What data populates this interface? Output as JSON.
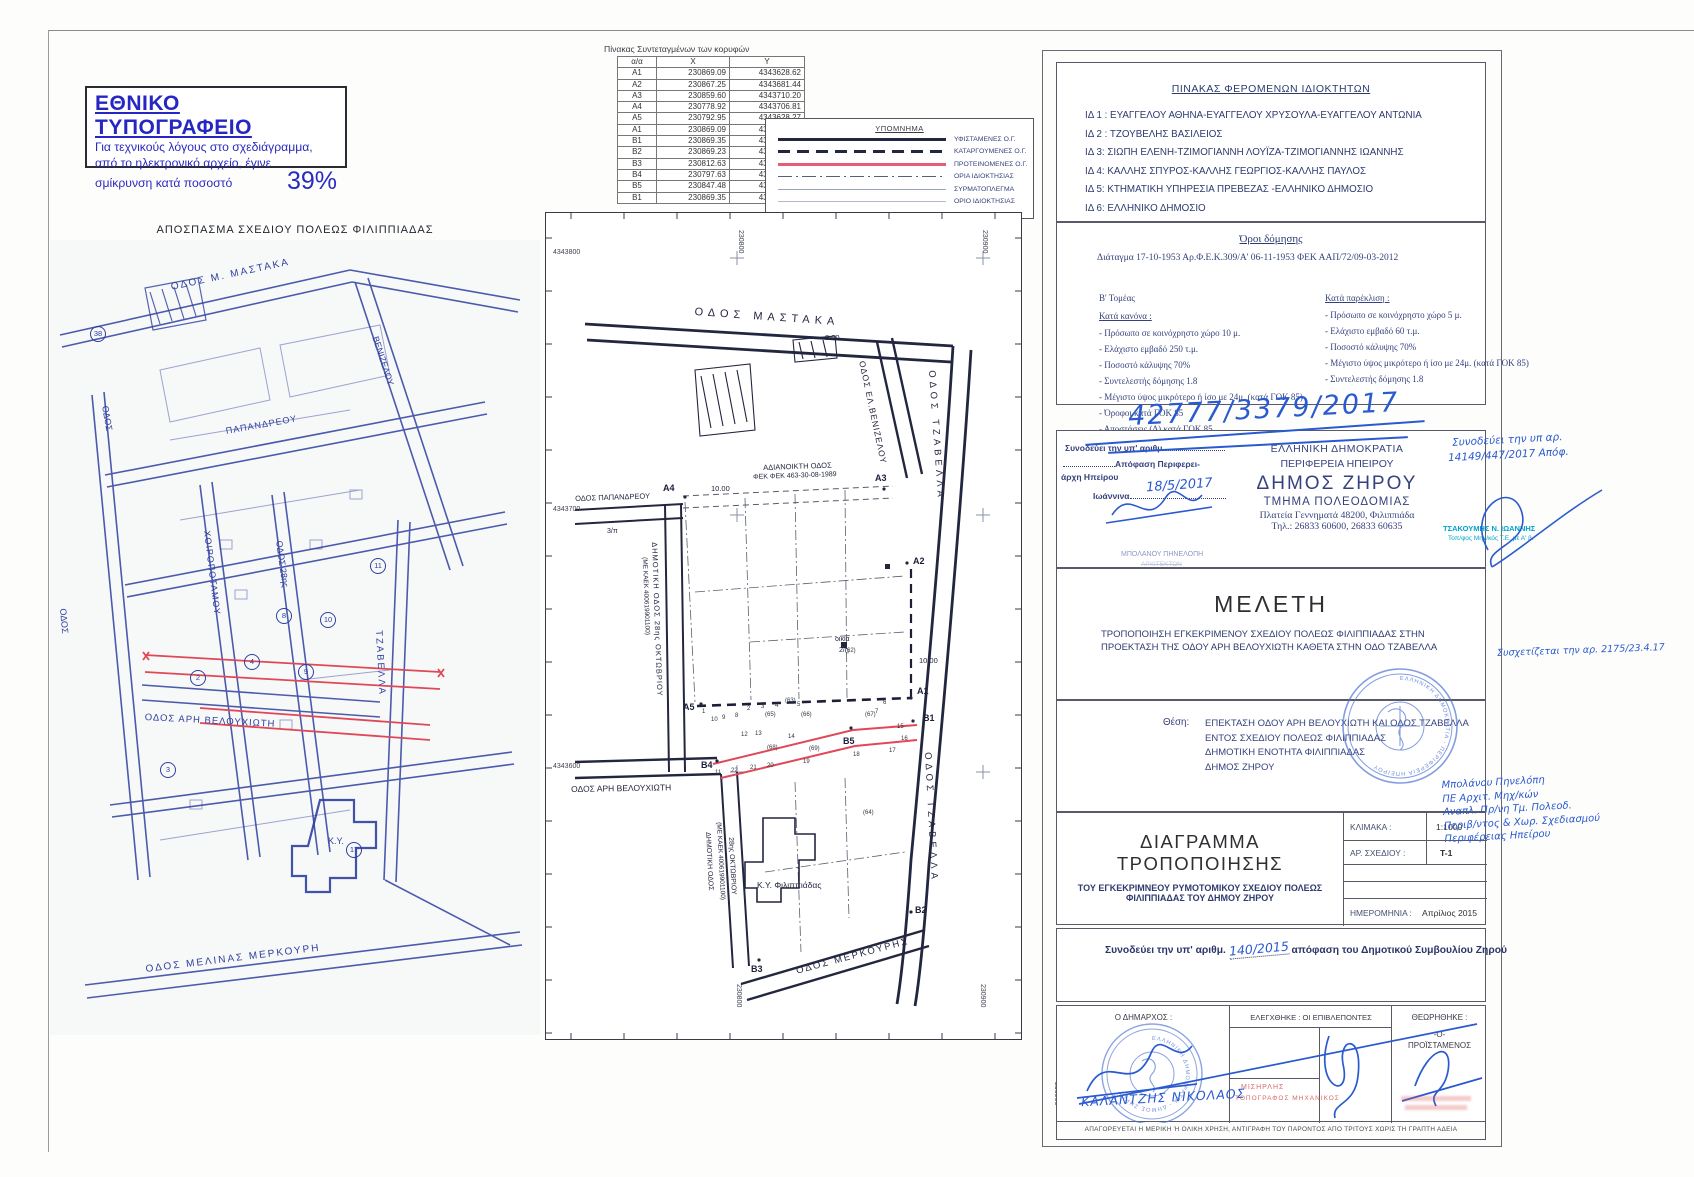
{
  "notice": {
    "title": "ΕΘΝΙΚΟ ΤΥΠΟΓΡΑΦΕΙΟ",
    "line1": "Για τεχνικούς λόγους στο σχεδιάγραμμα,",
    "line2": "από το ηλεκτρονικό αρχείο, έγινε",
    "line3": "σμίκρυνση κατά ποσοστό",
    "percent": "39%"
  },
  "coords_table": {
    "title": "Πίνακας Συντεταγμένων των κορυφών",
    "headers": [
      "α/α",
      "X",
      "Y"
    ],
    "rows": [
      [
        "A1",
        "230869.09",
        "4343628.62"
      ],
      [
        "A2",
        "230867.25",
        "4343681.44"
      ],
      [
        "A3",
        "230859.60",
        "4343710.20"
      ],
      [
        "A4",
        "230778.92",
        "4343706.81"
      ],
      [
        "A5",
        "230792.95",
        "4343628.27"
      ],
      [
        "A1",
        "230869.09",
        "4343628.62"
      ],
      [
        "B1",
        "230869.35",
        "4343619.13"
      ],
      [
        "B2",
        "230869.23",
        "4343544.37"
      ],
      [
        "B3",
        "230812.63",
        "4343526.20"
      ],
      [
        "B4",
        "230797.63",
        "4343604.03"
      ],
      [
        "B5",
        "230847.48",
        "4343619.03"
      ],
      [
        "B1",
        "230869.35",
        "4343619.13"
      ]
    ]
  },
  "legend": {
    "title": "ΥΠΟΜΝΗΜΑ",
    "items": [
      {
        "label": "ΥΦΙΣΤΑΜΕΝΕΣ Ο.Γ.",
        "style": "ls-solid-black"
      },
      {
        "label": "ΚΑΤΑΡΓΟΥΜΕΝΕΣ Ο.Γ.",
        "style": "ls-dashed-black"
      },
      {
        "label": "ΠΡΟΤΕΙΝΟΜΕΝΕΣ Ο.Γ.",
        "style": "ls-solid-red"
      },
      {
        "label": "ΟΡΙΑ ΙΔΙΟΚΤΗΣΙΑΣ",
        "style": "ls-dashdot"
      },
      {
        "label": "ΣΥΡΜΑΤΟΠΛΕΓΜΑ",
        "style": "ls-thin"
      },
      {
        "label": "ΟΡΙΟ ΙΔΙΟΚΤΗΣΙΑΣ",
        "style": "ls-thin2"
      }
    ]
  },
  "left_map": {
    "title": "ΑΠΟΣΠΑΣΜΑ ΣΧΕΔΙΟΥ ΠΟΛΕΩΣ ΦΙΛΙΠΠΙΑΔΑΣ",
    "labels": [
      {
        "t": "ΟΔΟΣ Μ. ΜΑΣΤΑΚΑ",
        "x": 120,
        "y": 42,
        "r": -12,
        "fs": 10,
        "ls": 2
      },
      {
        "t": "ΠΑΠΑΝΔΡΕΟΥ",
        "x": 175,
        "y": 186,
        "r": -10,
        "fs": 9,
        "ls": 1
      },
      {
        "t": "ΟΔΟΣ",
        "x": 60,
        "y": 165,
        "r": 80,
        "fs": 9
      },
      {
        "t": "ΒΕΝΙΖΕΛΟΥ",
        "x": 330,
        "y": 95,
        "r": 72,
        "fs": 9
      },
      {
        "t": "ΧΟΙΡΟΠΟΤΑΜΟΥ",
        "x": 162,
        "y": 290,
        "r": 83,
        "fs": 9,
        "ls": 1
      },
      {
        "t": "ΟΔΟΣ 28ης",
        "x": 234,
        "y": 300,
        "r": 82,
        "fs": 9
      },
      {
        "t": "ΟΔΟΣ ΑΡΗ ΒΕΛΟΥΧΙΩΤΗ",
        "x": 95,
        "y": 472,
        "r": 3,
        "fs": 9.5,
        "ls": 1
      },
      {
        "t": "ΤΖΑΒΕΛΛΑ",
        "x": 334,
        "y": 390,
        "r": 87,
        "fs": 9.5,
        "ls": 2
      },
      {
        "t": "ΟΔΟΣ",
        "x": 18,
        "y": 368,
        "r": 85,
        "fs": 9
      },
      {
        "t": "ΟΔΟΣ ΜΕΛΙΝΑΣ ΜΕΡΚΟΥΡΗ",
        "x": 95,
        "y": 724,
        "r": -7,
        "fs": 10,
        "ls": 2
      },
      {
        "t": "Κ.Υ.",
        "x": 278,
        "y": 596,
        "fs": 9
      }
    ],
    "circled_numbers": [
      {
        "t": "38",
        "x": 40,
        "y": 86
      },
      {
        "t": "8",
        "x": 226,
        "y": 368
      },
      {
        "t": "10",
        "x": 270,
        "y": 372
      },
      {
        "t": "4",
        "x": 194,
        "y": 414
      },
      {
        "t": "2",
        "x": 140,
        "y": 430
      },
      {
        "t": "3",
        "x": 110,
        "y": 522
      },
      {
        "t": "17",
        "x": 296,
        "y": 602
      },
      {
        "t": "9",
        "x": 248,
        "y": 424
      },
      {
        "t": "11",
        "x": 320,
        "y": 318
      }
    ]
  },
  "center_map": {
    "street_labels": [
      {
        "t": "ΟΔΟΣ ΜΑΣΤΑΚΑ",
        "x": 150,
        "y": 94,
        "r": 4,
        "fs": 11,
        "ls": 5
      },
      {
        "t": "ΟΔΟΣ ΕΛ.ΒΕΝΙΖΕΛΟΥ",
        "x": 322,
        "y": 148,
        "r": 78,
        "fs": 8.5,
        "ls": 1
      },
      {
        "t": "ΟΔΟΣ ΤΖΑΒΕΛΛΑ",
        "x": 392,
        "y": 158,
        "r": 86,
        "fs": 9.5,
        "ls": 4
      },
      {
        "t": "ΟΔΟΣ ΤΖΑΒΕΛΛΑ",
        "x": 388,
        "y": 540,
        "r": 87,
        "fs": 9.5,
        "ls": 4
      },
      {
        "t": "ΟΔΟΣ ΠΑΠΑΝΔΡΕΟΥ",
        "x": 30,
        "y": 282,
        "r": -2,
        "fs": 7.5
      },
      {
        "t": "ΑΔΙΑΝΟΙΚΤΗ ΟΔΟΣ",
        "x": 218,
        "y": 251,
        "r": -2,
        "fs": 7.5
      },
      {
        "t": "ΦΕΚ ΦΕΚ 463-30-08-1989",
        "x": 208,
        "y": 262,
        "r": -2,
        "fs": 7
      },
      {
        "t": "10.00",
        "x": 166,
        "y": 272,
        "fs": 7.5
      },
      {
        "t": "8.00",
        "x": 280,
        "y": 121,
        "fs": 7.5
      },
      {
        "t": "10.00",
        "x": 374,
        "y": 444,
        "fs": 7.5
      },
      {
        "t": "ΔΗΜΟΤΙΚΗ ΟΔΟΣ 28ης ΟΚΤΩΒΡΙΟΥ",
        "x": 114,
        "y": 330,
        "r": 88,
        "fs": 7.5,
        "ls": 1
      },
      {
        "t": "(ΜΕ ΚΑΕΚ 400619901100)",
        "x": 103,
        "y": 345,
        "r": 88,
        "fs": 6.5
      },
      {
        "t": "ΟΔΟΣ ΑΡΗ ΒΕΛΟΥΧΙΩΤΗ",
        "x": 26,
        "y": 572,
        "r": -1,
        "fs": 8.5
      },
      {
        "t": "ΔΗΜΟΤΙΚΗ ΟΔΟΣ",
        "x": 166,
        "y": 620,
        "r": 87,
        "fs": 7
      },
      {
        "t": "(ΜΕ ΚΑΕΚ 400619901100)",
        "x": 177,
        "y": 610,
        "r": 87,
        "fs": 6.5
      },
      {
        "t": "28ης ΟΚΤΩΒΡΙΟΥ",
        "x": 189,
        "y": 625,
        "r": 87,
        "fs": 7
      },
      {
        "t": "ΟΔΟΣ ΜΕΡΚΟΥΡΗΣ",
        "x": 250,
        "y": 754,
        "r": -15,
        "fs": 9.5,
        "ls": 2
      },
      {
        "t": "Κ.Υ. Φιλιππιάδας",
        "x": 212,
        "y": 668,
        "fs": 8.5
      },
      {
        "t": "οικία",
        "x": 290,
        "y": 424,
        "fs": 7
      },
      {
        "t": "2/η",
        "x": 294,
        "y": 435,
        "fs": 7
      },
      {
        "t": "3/π",
        "x": 62,
        "y": 316,
        "fs": 7
      }
    ],
    "point_labels": [
      {
        "t": "A1",
        "x": 372,
        "y": 474,
        "fs": 9,
        "b": 1
      },
      {
        "t": "A2",
        "x": 368,
        "y": 344,
        "fs": 9,
        "b": 1
      },
      {
        "t": "A3",
        "x": 330,
        "y": 261,
        "fs": 9,
        "b": 1
      },
      {
        "t": "A4",
        "x": 118,
        "y": 271,
        "fs": 9,
        "b": 1
      },
      {
        "t": "A5",
        "x": 138,
        "y": 490,
        "fs": 9,
        "b": 1
      },
      {
        "t": "B1",
        "x": 378,
        "y": 501,
        "fs": 9,
        "b": 1
      },
      {
        "t": "B2",
        "x": 370,
        "y": 693,
        "fs": 9,
        "b": 1
      },
      {
        "t": "B3",
        "x": 206,
        "y": 752,
        "fs": 9,
        "b": 1
      },
      {
        "t": "B4",
        "x": 156,
        "y": 548,
        "fs": 9,
        "b": 1
      },
      {
        "t": "B5",
        "x": 298,
        "y": 524,
        "fs": 9,
        "b": 1
      }
    ],
    "small_labels": [
      {
        "t": "1",
        "x": 157,
        "y": 497,
        "fs": 6
      },
      {
        "t": "10",
        "x": 166,
        "y": 505,
        "fs": 6
      },
      {
        "t": "9",
        "x": 177,
        "y": 503,
        "fs": 6
      },
      {
        "t": "8",
        "x": 190,
        "y": 501,
        "fs": 6
      },
      {
        "t": "2",
        "x": 202,
        "y": 494,
        "fs": 6
      },
      {
        "t": "3",
        "x": 216,
        "y": 492,
        "fs": 6
      },
      {
        "t": "4",
        "x": 230,
        "y": 491,
        "fs": 6
      },
      {
        "t": "5",
        "x": 252,
        "y": 490,
        "fs": 6
      },
      {
        "t": "6",
        "x": 338,
        "y": 488,
        "fs": 6
      },
      {
        "t": "7",
        "x": 330,
        "y": 497,
        "fs": 6
      },
      {
        "t": "12",
        "x": 196,
        "y": 520,
        "fs": 6
      },
      {
        "t": "13",
        "x": 210,
        "y": 519,
        "fs": 6
      },
      {
        "t": "14",
        "x": 243,
        "y": 522,
        "fs": 6
      },
      {
        "t": "15",
        "x": 352,
        "y": 512,
        "fs": 6
      },
      {
        "t": "16",
        "x": 356,
        "y": 524,
        "fs": 6
      },
      {
        "t": "17",
        "x": 344,
        "y": 536,
        "fs": 6
      },
      {
        "t": "18",
        "x": 308,
        "y": 540,
        "fs": 6
      },
      {
        "t": "19",
        "x": 258,
        "y": 547,
        "fs": 6
      },
      {
        "t": "20",
        "x": 222,
        "y": 551,
        "fs": 6
      },
      {
        "t": "21",
        "x": 205,
        "y": 553,
        "fs": 6
      },
      {
        "t": "22",
        "x": 186,
        "y": 556,
        "fs": 6
      },
      {
        "t": "11",
        "x": 170,
        "y": 558,
        "fs": 6
      },
      {
        "t": "(63)",
        "x": 240,
        "y": 486,
        "fs": 6
      },
      {
        "t": "(65)",
        "x": 220,
        "y": 500,
        "fs": 6
      },
      {
        "t": "(66)",
        "x": 256,
        "y": 500,
        "fs": 6
      },
      {
        "t": "(67)",
        "x": 320,
        "y": 500,
        "fs": 6
      },
      {
        "t": "(68)",
        "x": 222,
        "y": 533,
        "fs": 6
      },
      {
        "t": "(69)",
        "x": 264,
        "y": 534,
        "fs": 6
      },
      {
        "t": "(64)",
        "x": 318,
        "y": 598,
        "fs": 6
      },
      {
        "t": "(62)",
        "x": 300,
        "y": 436,
        "fs": 6
      }
    ],
    "edge_labels": [
      {
        "t": "4343800",
        "x": 553,
        "y": 249,
        "fs": 7
      },
      {
        "t": "4343700",
        "x": 553,
        "y": 506,
        "fs": 7
      },
      {
        "t": "4343600",
        "x": 553,
        "y": 763,
        "fs": 7
      },
      {
        "t": "230800",
        "x": 744,
        "y": 230,
        "r": 90,
        "fs": 7
      },
      {
        "t": "230900",
        "x": 988,
        "y": 230,
        "r": 90,
        "fs": 7
      },
      {
        "t": "230800",
        "x": 742,
        "y": 984,
        "r": 90,
        "fs": 7
      },
      {
        "t": "230900",
        "x": 986,
        "y": 984,
        "r": 90,
        "fs": 7
      },
      {
        "t": "230900",
        "x": 1060,
        "y": 1082,
        "r": 90,
        "fs": 7
      }
    ]
  },
  "owners_panel": {
    "title": "ΠΙΝΑΚΑΣ ΦΕΡΟΜΕΝΩΝ ΙΔΙΟΚΤΗΤΩΝ",
    "items": [
      "ΙΔ 1 : ΕΥΑΓΓΕΛΟΥ ΑΘΗΝΑ-ΕΥΑΓΓΕΛΟΥ ΧΡΥΣΟΥΛΑ-ΕΥΑΓΓΕΛΟΥ ΑΝΤΩΝΙΑ",
      "ΙΔ 2 : ΤΖΟΥΒΕΛΗΣ ΒΑΣΙΛΕΙΟΣ",
      "ΙΔ 3: ΣΙΩΠΗ ΕΛΕΝΗ-ΤΖΙΜΟΓΙΑΝΝΗ ΛΟΥΪΖΑ-ΤΖΙΜΟΓΙΑΝΝΗΣ ΙΩΑΝΝΗΣ",
      "ΙΔ 4: ΚΑΛΛΗΣ ΣΠΥΡΟΣ-ΚΑΛΛΗΣ ΓΕΩΡΓΙΟΣ-ΚΑΛΛΗΣ ΠΑΥΛΟΣ",
      "ΙΔ 5: ΚΤΗΜΑΤΙΚΗ ΥΠΗΡΕΣΙΑ ΠΡΕΒΕΖΑΣ -ΕΛΛΗΝΙΚΟ ΔΗΜΟΣΙΟ",
      "ΙΔ 6: ΕΛΛΗΝΙΚΟ ΔΗΜΟΣΙΟ",
      "ΙΔ 7:  ΔΗΜΟΣ ΖΗΡΟΥ"
    ]
  },
  "terms_panel": {
    "title": "Όροι δόμησης",
    "decree": "Διάταγμα 17-10-1953 Αρ.Φ.Ε.Κ.309/Α' 06-11-1953  ΦΕΚ ΑΑΠ/72/09-03-2012",
    "sector": "Β' Τομέας",
    "rule_title": "Κατά κανόνα :",
    "rule_items": [
      "- Πρόσωπο σε κοινόχρηστο χώρο 10 μ.",
      "- Ελάχιστο εμβαδό 250 τ.μ.",
      "- Ποσοστό κάλυψης 70%",
      "- Συντελεστής δόμησης 1.8",
      "- Μέγιστο ύψος μικρότερο ή ίσο με 24μ. (κατά ΓΟΚ 85)",
      "- Όροφοι  κατά ΓΟΚ 85",
      "- Αποστάσεις (Δ) κατά ΓΟΚ 85"
    ],
    "exception_title": "Κατά παρέκλιση :",
    "exception_items": [
      "- Πρόσωπο σε κοινόχρηστο χώρο 5 μ.",
      "- Ελάχιστο εμβαδό 60 τ.μ.",
      "- Ποσοστό κάλυψης 70%",
      "- Μέγιστο ύψος μικρότερο ή ίσο με 24μ. (κατά ΓΟΚ 85)",
      "- Συντελεστής δόμησης 1.8"
    ]
  },
  "authority_panel": {
    "accompany_label": "Συνοδεύει την υπ' αριθμ.",
    "decision_label": "Απόφαση Περιφερει-",
    "decision_label2": "άρχη Ηπείρου",
    "city_label": "Ιωάννινα",
    "republic": "ΕΛΛΗΝΙΚΗ ΔΗΜΟΚΡΑΤΙΑ",
    "region": "ΠΕΡΙΦΕΡΕΙΑ ΗΠΕΙΡΟΥ",
    "municipality": "ΔΗΜΟΣ ΖΗΡΟΥ",
    "department": "ΤΜΗΜΑ  ΠΟΛΕΟΔΟΜΙΑΣ",
    "address": "Πλατεία Γεννηματά 48200, Φιλιππιάδα",
    "phone": "Τηλ.: 26833 60600, 26833 60635"
  },
  "study_panel": {
    "title": "ΜΕΛΕΤΗ",
    "description": "ΤΡΟΠΟΠΟΙΗΣΗ ΕΓΚΕΚΡΙΜΕΝΟΥ ΣΧΕΔΙΟΥ ΠΟΛΕΩΣ ΦΙΛΙΠΠΙΑΔΑΣ ΣΤΗΝ ΠΡΟΕΚΤΑΣΗ ΤΗΣ ΟΔΟΥ ΑΡΗ ΒΕΛΟΥΧΙΩΤΗ ΚΑΘΕΤΑ ΣΤΗΝ ΟΔΟ ΤΖΑΒΕΛΛΑ"
  },
  "location_panel": {
    "label": "Θέση:",
    "lines": [
      "ΕΠΕΚΤΑΣΗ ΟΔΟΥ ΑΡΗ ΒΕΛΟΥΧΙΩΤΗ ΚΑΙ ΟΔΟΣ ΤΖΑΒΕΛΛΑ",
      "ΕΝΤΟΣ ΣΧΕΔΙΟΥ ΠΟΛΕΩΣ ΦΙΛΙΠΠΙΑΔΑΣ",
      "ΔΗΜΟΤΙΚΗ ΕΝΟΤΗΤΑ ΦΙΛΙΠΠΙΑΔΑΣ",
      "ΔΗΜΟΣ ΖΗΡΟΥ"
    ]
  },
  "diagram_panel": {
    "title": "ΔΙΑΓΡΑΜΜΑ ΤΡΟΠΟΠΟΙΗΣΗΣ",
    "subtitle1": "ΤΟΥ ΕΓΚΕΚΡΙΜΝΕΟΥ ΡΥΜΟΤΟΜΙΚΟΥ ΣΧΕΔΙΟΥ ΠΟΛΕΩΣ",
    "subtitle2": "ΦΙΛΙΠΠΙΑΔΑΣ ΤΟΥ ΔΗΜΟΥ ΖΗΡΟΥ",
    "scale_label": "ΚΛΙΜΑΚΑ :",
    "scale_value": "1:1000",
    "drawing_no_label": "ΑΡ. ΣΧΕΔΙΟΥ :",
    "drawing_no_value": "Τ-1",
    "date_label": "ΗΜΕΡΟΜΗΝΙΑ :",
    "date_value": "Απρίλιος 2015"
  },
  "council_row": {
    "prefix": "Συνοδεύει την υπ' αριθμ.",
    "handwritten_no": "140/2015",
    "suffix": "απόφαση του Δημοτικού Συμβουλίου Ζηρού"
  },
  "signature_row": {
    "mayor_label": "Ο ΔΗΜΑΡΧΟΣ :",
    "mayor_name": "ΚΑΛΑΝΤΖΗΣ  ΝΙΚΟΛΑΟΣ",
    "checked_label": "ΕΛΕΓΧΘΗΚΕ : ΟΙ ΕΠΙΒΛΕΠΟΝΤΕΣ",
    "approved_label": "ΘΕΩΡΗΘΗΚΕ :",
    "approved_sub1": "-Ο-",
    "approved_sub2": "ΠΡΟΪΣΤΑΜΕΝΟΣ"
  },
  "disclaimer": "ΑΠΑΓΟΡΕΥΕΤΑΙ Η ΜΕΡΙΚΗ Ή ΟΛΙΚΗ ΧΡΗΣΗ, ΑΝΤΙΓΡΑΦΗ ΤΟΥ ΠΑΡΟΝΤΟΣ ΑΠΟ ΤΡΙΤΟΥΣ ΧΩΡΙΣ ΤΗ ΓΡΑΠΤΗ ΑΔΕΙΑ",
  "handwriting": {
    "ref_top": "42777/3379/2017",
    "date": "18/5/2017",
    "right_line1": "Συνοδεύει την υπ αρ.",
    "right_line2": "14149/447/2017 Απόφ.",
    "margin_note_top": "Συσχετίζεται την αρ. 2175/23.4.17",
    "margin_note_lines": [
      "Μπολάνου Πηνελόπη",
      "ΠΕ Αρχιτ. Μηχ/κών",
      "Αναπλ. Πρ/νη Τμ. Πολεοδ.",
      "Περιβ/ντος & Χωρ. Σχεδιασμού",
      "Περιφέρειας Ηπείρου"
    ]
  },
  "stamps": {
    "architect_name": "ΜΠΟΛΑΝΟΥ ΠΗΝΕΛΟΠΗ",
    "architect_role": "ΑΡΧΙΤΕΚΤΩΝ",
    "surveyor_name": "ΤΣΑΚΟΥΜΗΣ Ν. ΙΩΑΝΝΗΣ",
    "surveyor_role": "Τοπ/φος Μηχ/κός Τ.Ε. με Α' β.",
    "red_line1": "ΜΙΣΗΡΛΗΣ",
    "red_line2": "ΤΟΠΟΓΡΑΦΟΣ ΜΗΧΑΝΙΚΟΣ",
    "round_large_text": "ΕΛΛΗΝΙΚΗ ΔΗΜΟΚΡΑΤΙΑ - ΠΕΡΙΦΕΡΕΙΑ ΗΠΕΙΡΟΥ",
    "round_mayor_text": "ΕΛΛΗΝΙΚΗ ΔΗΜΟΚΡΑΤΙΑ - ΔΗΜΟΣ ΖΗΡΟΥ"
  },
  "colors": {
    "ink_blue": "#2e3f9f",
    "plan_dark": "#23263f",
    "proposed_red": "#e04858",
    "hand_blue": "#2a5ad0",
    "stamp_teal": "#00a4cc"
  }
}
